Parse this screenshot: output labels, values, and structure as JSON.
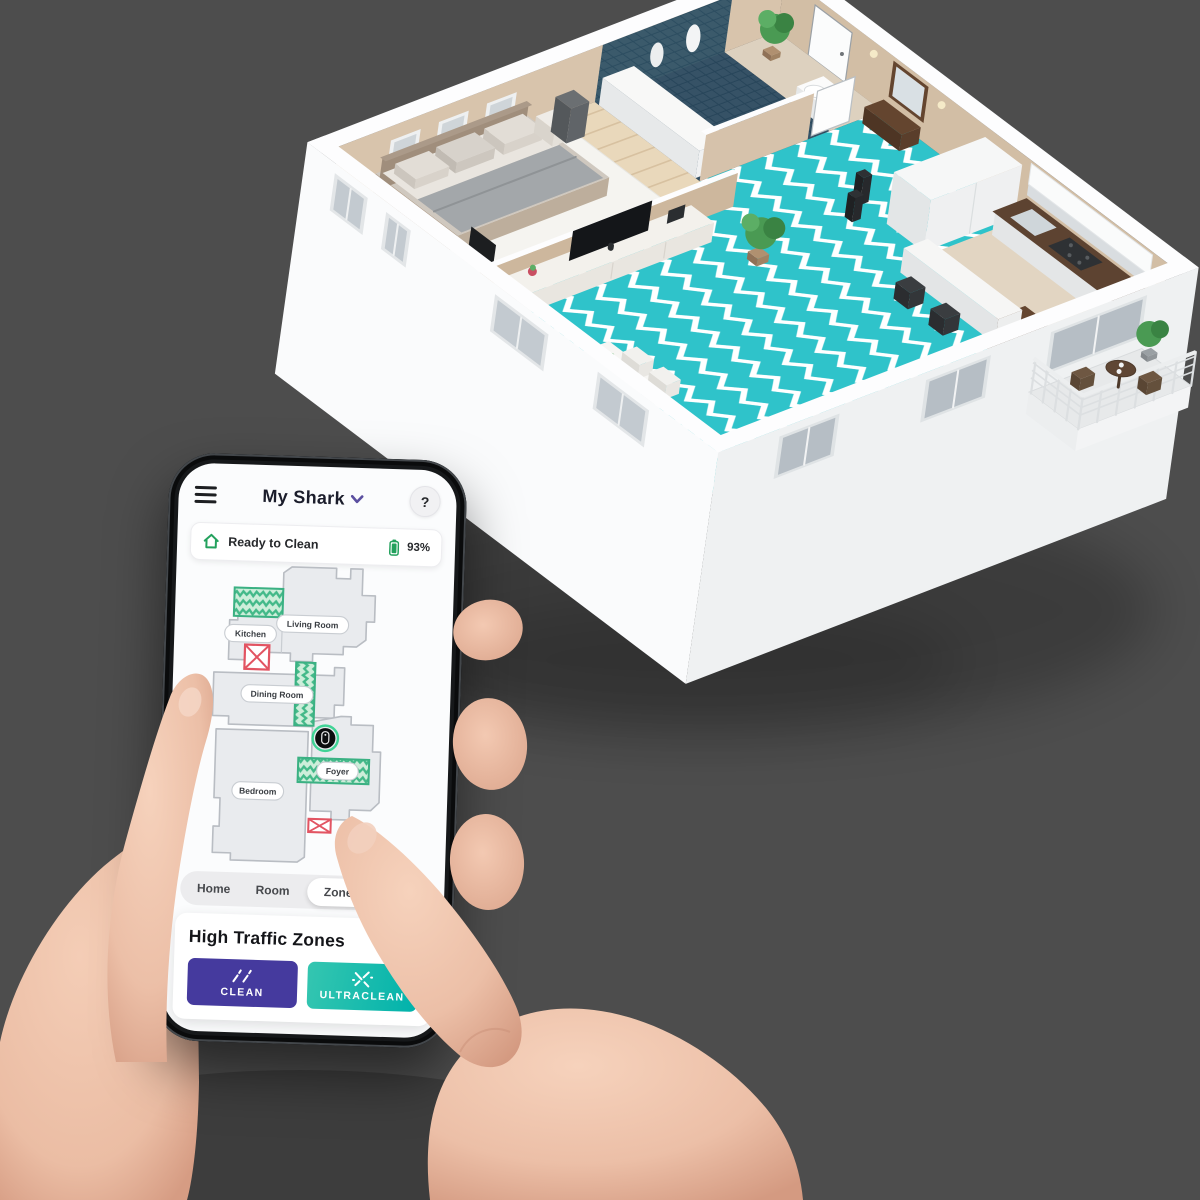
{
  "background": "#4d4d4d",
  "phone": {
    "header": {
      "menu_icon": "hamburger-icon",
      "title": "My Shark",
      "title_dropdown_icon": "chevron-down-icon",
      "help_label": "?"
    },
    "status": {
      "home_icon": "home-icon",
      "text": "Ready to Clean",
      "battery_icon": "battery-icon",
      "battery_level": "93%"
    },
    "map": {
      "rooms": [
        {
          "name": "Living Room"
        },
        {
          "name": "Kitchen"
        },
        {
          "name": "Dining Room"
        },
        {
          "name": "Bedroom"
        },
        {
          "name": "Foyer"
        }
      ],
      "high_traffic_zones": [
        "Kitchen",
        "Dining Room",
        "Foyer"
      ],
      "no_go_zones": 2,
      "robot_icon": "robot-vacuum-icon"
    },
    "tabs": [
      {
        "label": "Home",
        "active": false
      },
      {
        "label": "Room",
        "active": false
      },
      {
        "label": "Zone",
        "active": true
      },
      {
        "label": "Spot",
        "active": false
      }
    ],
    "panel": {
      "title": "High Traffic Zones",
      "buttons": [
        {
          "label": "CLEAN",
          "icon": "sparkle-clean-icon",
          "color": "#453a9e"
        },
        {
          "label": "ULTRACLEAN",
          "icon": "sparkle-ultra-icon",
          "color": "#00b2ab"
        }
      ]
    }
  },
  "colors": {
    "accent_purple": "#5b4fa0",
    "battery_green": "#23a15d",
    "zone_green": "#3bb183",
    "zone_fill": "#cdeeda",
    "nogo_red": "#e25462",
    "robot_ring": "#2fd08c",
    "map_floor": "#e9ebee",
    "map_outline": "#b9bdc3",
    "teal_floor": "#2fc3ca"
  },
  "scene": {
    "colors": {
      "wall": "#f8f9fa",
      "wallShade": "#eef0f2",
      "rim": "#fdfdfe",
      "beige": "#d8c4ac",
      "beige2": "#d2bea5",
      "beigeShade": "#cdb79d",
      "navy": "#2c4d60",
      "navyFloor": "#27455a",
      "wood": "#e9d8bb",
      "teal": "#2fc3ca",
      "furn": "#f4f3f0",
      "furnSW": "#dfdcd6",
      "furnSE": "#eae7e2",
      "darkwood": "#64452f",
      "glass": "#c3cad0",
      "glassDark": "#b6bec5",
      "plant": "#4a9a53",
      "plantDark": "#3a8343",
      "railing": "#dcdfe1",
      "skin": "#eec3ac",
      "skinShade": "#d89e85"
    }
  }
}
